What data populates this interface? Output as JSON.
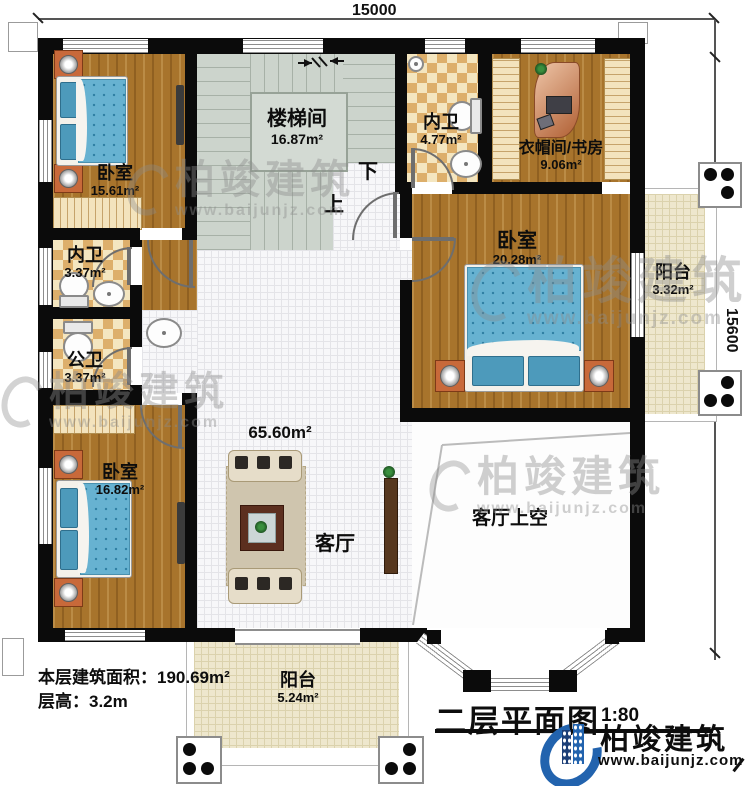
{
  "dimensions": {
    "top": "15000",
    "right": "15600"
  },
  "rooms": {
    "bedroom_tl": {
      "name": "卧室",
      "area": "15.61m²"
    },
    "stairwell": {
      "name": "楼梯间",
      "area": "16.87m²"
    },
    "bath_top": {
      "name": "内卫",
      "area": "4.77m²"
    },
    "cloak_study": {
      "name": "衣帽间/书房",
      "area": "9.06m²"
    },
    "bedroom_r": {
      "name": "卧室",
      "area": "20.28m²"
    },
    "balcony_r": {
      "name": "阳台",
      "area": "3.32m²"
    },
    "bath_mid": {
      "name": "内卫",
      "area": "3.37m²"
    },
    "bath_pub": {
      "name": "公卫",
      "area": "3.37m²"
    },
    "bedroom_bl": {
      "name": "卧室",
      "area": "16.82m²"
    },
    "living": {
      "name": "客厅",
      "area": "65.60m²"
    },
    "living_void": {
      "name": "客厅上空"
    },
    "balcony_b": {
      "name": "阳台",
      "area": "5.24m²"
    }
  },
  "stairs": {
    "up": "上",
    "down": "下"
  },
  "footer": {
    "area_label": "本层建筑面积：",
    "area_value": "190.69m²",
    "height_label": "层高：",
    "height_value": "3.2m"
  },
  "titleblock": {
    "title": "二层平面图",
    "scale": "1:80"
  },
  "brand": {
    "name": "柏竣建筑",
    "website": "www.baijunjz.com",
    "color": "#2263ae"
  },
  "watermark": {
    "name": "柏竣建筑",
    "website": "www.baijunjz.com"
  }
}
